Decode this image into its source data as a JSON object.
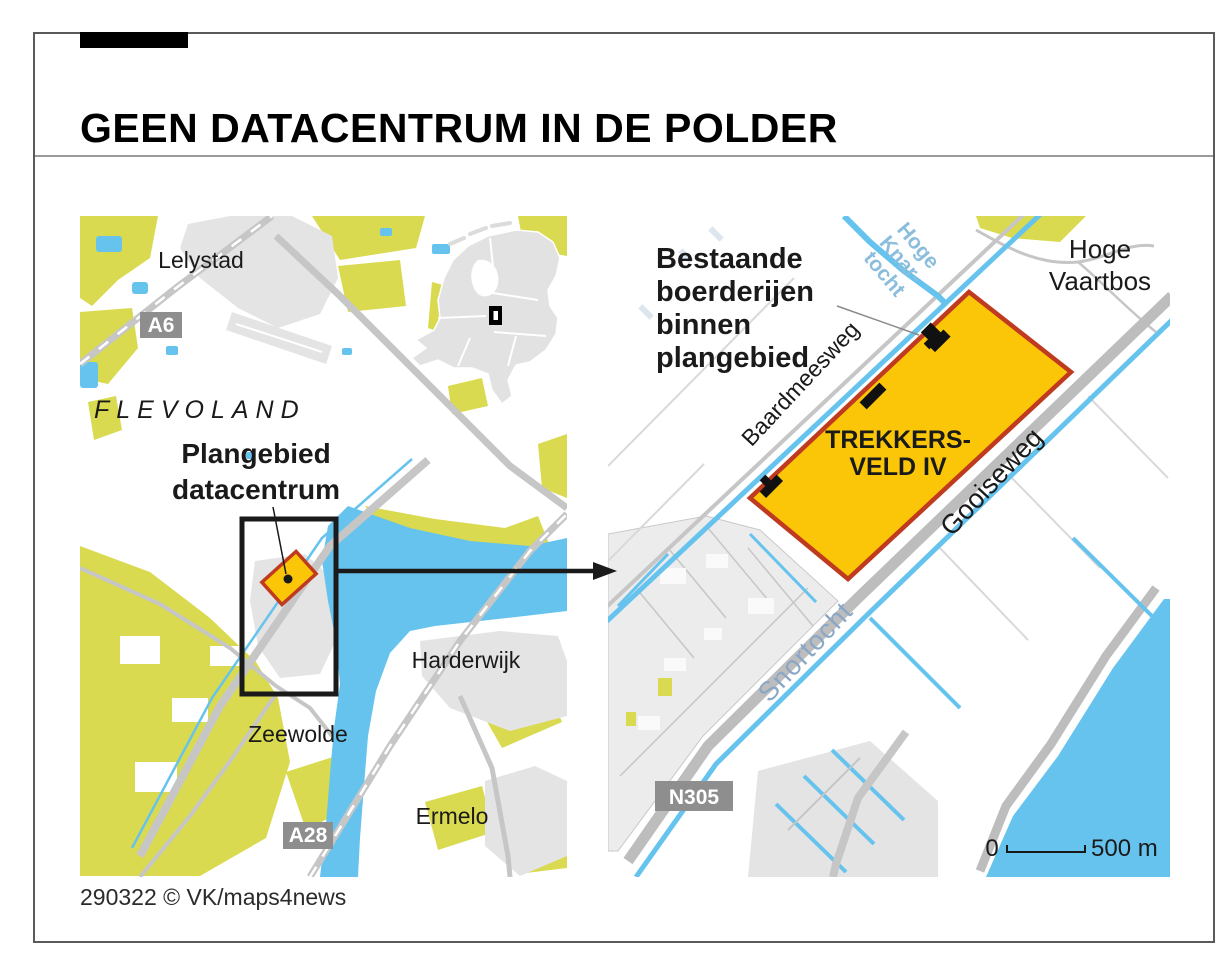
{
  "header": {
    "title": "GEEN DATACENTRUM IN DE POLDER"
  },
  "footer": {
    "credit": "290322 © VK/maps4news"
  },
  "colors": {
    "field": "#d9da4f",
    "water": "#66c3ee",
    "urban": "#e4e4e4",
    "urban_light": "#ececec",
    "inset": "#e2e2e2",
    "road": "#c6c6c6",
    "road_wide": "#bdbdbd",
    "badge": "#8e8e8e",
    "plan_fill": "#fcc608",
    "plan_stroke": "#bf3a1f",
    "ink": "#1a1a1a",
    "label_water": "#8aa7c5",
    "label_canal": "#8bbedd",
    "leader": "#8a8a8a"
  },
  "overview_map": {
    "cities": {
      "lelystad": "Lelystad",
      "harderwijk": "Harderwijk",
      "zeewolde": "Zeewolde",
      "ermelo": "Ermelo"
    },
    "region": "FLEVOLAND",
    "plan_label": {
      "line1": "Plangebied",
      "line2": "datacentrum"
    },
    "road_badges": {
      "a6": "A6",
      "a28": "A28"
    }
  },
  "detail_map": {
    "annotation": {
      "line1": "Bestaande",
      "line2": "boerderijen",
      "line3": "binnen",
      "line4": "plangebied"
    },
    "area": {
      "line1": "TREKKERS-",
      "line2": "VELD IV"
    },
    "roads": {
      "baardmeesweg": "Baardmeesweg",
      "gooiseweg": "Gooiseweg"
    },
    "road_badge_n305": "N305",
    "waterways": {
      "knartocht": {
        "line1": "Hoge",
        "line2": "Knar-",
        "line3": "tocht"
      },
      "snortocht": "Snortocht"
    },
    "forest": {
      "line1": "Hoge",
      "line2": "Vaartbos"
    },
    "scale_bar": {
      "start": "0",
      "end": "500 m"
    }
  }
}
